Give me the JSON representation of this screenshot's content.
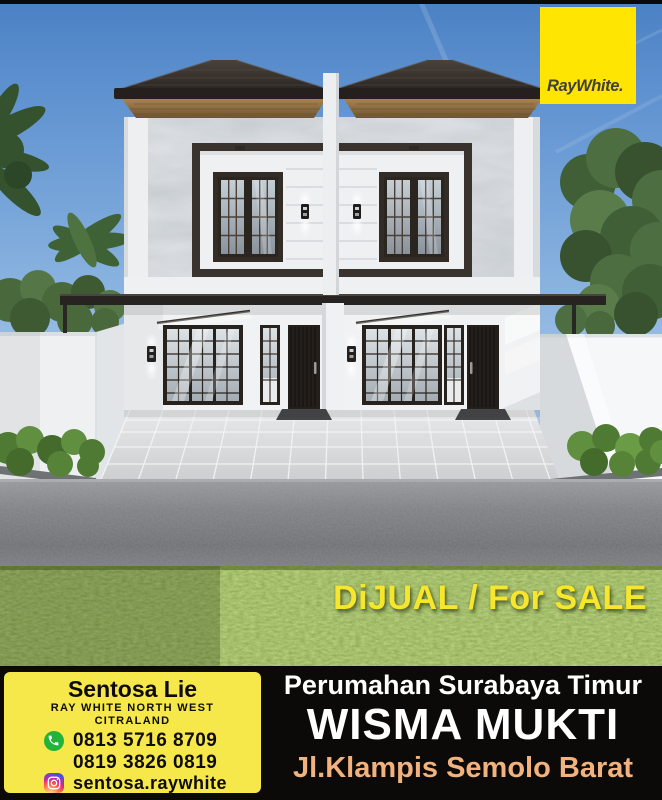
{
  "brand": {
    "logo_text": "RayWhite.",
    "logo_bg": "#FFE501",
    "logo_text_color": "#403F3B"
  },
  "sale": {
    "text": "DiJUAL / For SALE",
    "color": "#F6E62E"
  },
  "footer": {
    "bg": "#0B0A08",
    "agent": {
      "card_bg": "#F6E84B",
      "name": "Sentosa Lie",
      "office1": "RAY WHITE NORTH WEST",
      "office2": "CITRALAND",
      "phone1": "0813 5716 8709",
      "phone2": "0819 3826 0819",
      "instagram": "sentosa.raywhite",
      "whatsapp_icon_color": "#23B33A"
    },
    "location": {
      "area": "Perumahan Surabaya Timur",
      "name": "WISMA MUKTI",
      "street": "Jl.Klampis Semolo Barat",
      "street_color": "#F2B27D"
    }
  }
}
